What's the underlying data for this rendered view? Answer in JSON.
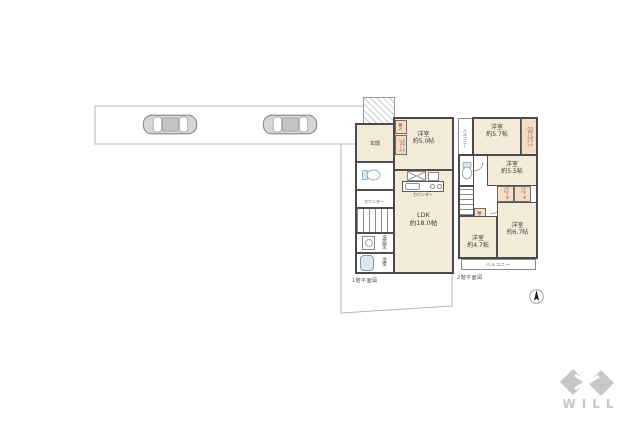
{
  "site": {
    "parking_car_count": "2"
  },
  "floor1": {
    "caption": "1階平面図",
    "entrance_label": "玄関",
    "storage_label": "物入",
    "shoe_closet_line1": "シューズ",
    "shoe_closet_line2": "クローク",
    "west_room_name": "洋室",
    "west_room_size": "約5.0帖",
    "ldk_name": "LDK",
    "ldk_size": "約18.0帖",
    "kitchen_counter_label": "カウンター",
    "hall_counter_label": "カウンター",
    "washroom_label": "洗面室",
    "bathroom_label": "浴室"
  },
  "floor2": {
    "caption": "2階平面図",
    "balcony_side_label": "バルコニー",
    "balcony_bottom_label": "バルコニー",
    "room_a_name": "洋室",
    "room_a_size": "約5.7帖",
    "wic_line1": "ウォークイン",
    "wic_line2": "クローゼット",
    "room_b_name": "洋室",
    "room_b_size": "約5.5帖",
    "closet1_label": "クローゼット",
    "closet2_label": "クローゼット",
    "storage_label": "物入",
    "room_c_name": "洋室",
    "room_c_size": "約4.7帖",
    "room_d_name": "洋室",
    "room_d_size": "約6.7帖"
  },
  "logo": {
    "text": "WILL"
  },
  "colors": {
    "room_fill": "#f4ead8",
    "closet_fill": "#f7dbc5",
    "wall": "#4f4f4f",
    "boundary": "#b5b5b5",
    "fixture_blue": "#d9e9f4",
    "logo_gray": "#c7c7c7"
  }
}
